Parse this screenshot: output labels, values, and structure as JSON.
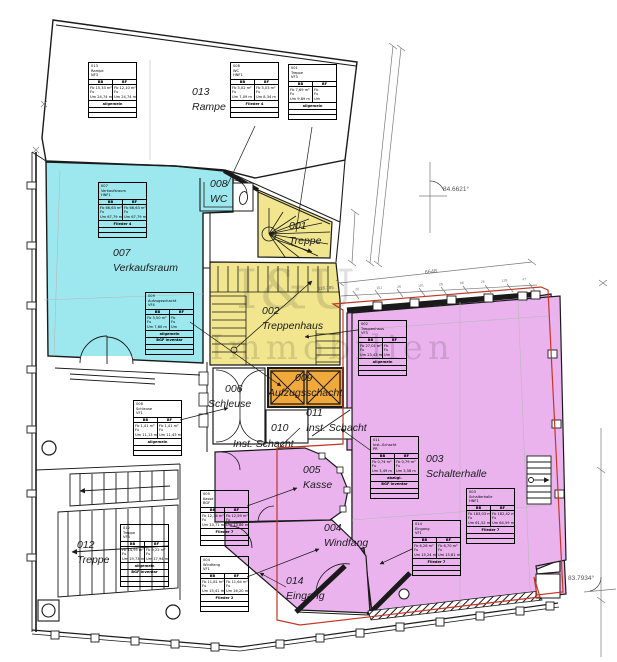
{
  "watermark": {
    "line1": "I&U",
    "line2": "Immobilien"
  },
  "rooms": {
    "rampe": {
      "number": "013",
      "name": "Rampe"
    },
    "wc": {
      "number": "008",
      "name": "WC"
    },
    "treppe1": {
      "number": "001",
      "name": "Treppe"
    },
    "verkaufsraum": {
      "number": "007",
      "name": "Verkaufsraum"
    },
    "treppenhaus": {
      "number": "002",
      "name": "Treppenhaus"
    },
    "aufzugsschacht": {
      "number": "009",
      "name": "Aufzugsschacht"
    },
    "schleuse": {
      "number": "006",
      "name": "Schleuse"
    },
    "schacht10": {
      "number": "010",
      "name": ""
    },
    "schacht11": {
      "number": "011",
      "name": "Inst. Schacht"
    },
    "schacht11b": {
      "name": "Inst. Schacht"
    },
    "kasse": {
      "number": "005",
      "name": "Kasse"
    },
    "schalterhalle": {
      "number": "003",
      "name": "Schalterhalle"
    },
    "windfang": {
      "number": "004",
      "name": "Windfang"
    },
    "eingang": {
      "number": "014",
      "name": "Eingang"
    },
    "treppe12": {
      "number": "012",
      "name": "Treppe"
    }
  },
  "dimensions": {
    "angle_top": "84.6621°",
    "angle_right": "83.7934°",
    "chain_label": "118.385",
    "span": "6648",
    "chain_ticks": [
      "20",
      "151",
      "26",
      "101",
      "26",
      "88",
      "26",
      "128",
      "47"
    ]
  },
  "stamps": [
    {
      "no": "013",
      "name": "Rampe",
      "type": "NF3",
      "c1": "BB",
      "c2": "BF",
      "l": "Fb 15,33 m²<br>Fu<br>Um 24,74 m",
      "r": "Fb 12,10 m²<br>Fu<br>Um 24,74 m",
      "footer": "allgemein",
      "footer2": ""
    },
    {
      "no": "008",
      "name": "WC",
      "type": "HNF1",
      "c1": "BB",
      "c2": "BF",
      "l": "Fb 5,02 m²<br>Fu<br>Um 7,09 m",
      "r": "Fb 5,03 m²<br>Fu<br>Um 8,34 m",
      "footer": "Flieder 4",
      "footer2": ""
    },
    {
      "no": "001",
      "name": "Treppe",
      "type": "VF3",
      "c1": "BB",
      "c2": "BF",
      "l": "Fb 7,69 m²<br>Fu<br>Um 9,89 m",
      "r": "Fb<br>Fu<br>Um",
      "footer": "allgemein",
      "footer2": ""
    },
    {
      "no": "007",
      "name": "Verkaufsraum",
      "type": "HNF1",
      "c1": "BB",
      "c2": "BF",
      "l": "Fb 66,63 m²<br>Fu<br>Um 67,79 m",
      "r": "Fb 66,63 m²<br>Fu<br>Um 67,79 m",
      "footer": "Flieder 4",
      "footer2": ""
    },
    {
      "no": "009",
      "name": "Aufzugsschacht",
      "type": "VF4",
      "c1": "BB",
      "c2": "BF",
      "l": "Fb 3,50 m²<br>Fu<br>Um 7,60 m",
      "r": "Fb<br>Fu<br>Um",
      "footer": "allgemein",
      "footer2": "BGF inventar"
    },
    {
      "no": "006",
      "name": "Schleuse",
      "type": "VF1",
      "c1": "BB",
      "c2": "BF",
      "l": "Fb 1,41 m²<br>Fu<br>Um 11,13 m",
      "r": "Fb 1,41 m²<br>Fu<br>Um 11,43 m",
      "footer": "allgemein",
      "footer2": ""
    },
    {
      "no": "002",
      "name": "Treppenhaus",
      "type": "VF3",
      "c1": "BB",
      "c2": "BF",
      "l": "Fb 27,01 m²<br>Fu<br>Um 23,43 m",
      "r": "Fb<br>Fu<br>Um",
      "footer": "allgemein",
      "footer2": ""
    },
    {
      "no": "011",
      "name": "Inst.-Schacht",
      "type": "PR",
      "c1": "BB",
      "c2": "BF",
      "l": "Fb 0,74 m²<br>Fu<br>Um 3,49 m",
      "r": "Fb 0,79 m²<br>Fu<br>Um 3,58 m",
      "footer": "abzügl.",
      "footer2": "BGF inventar"
    },
    {
      "no": "003",
      "name": "Schalterhalle",
      "type": "HNF1",
      "c1": "BB",
      "c2": "BF",
      "l": "Fb 183,03 m²<br>Fu<br>Um 61,52 m",
      "r": "Fb 182,42 m²<br>Fu<br>Um 64,59 m",
      "footer": "Flieder 7",
      "footer2": ""
    },
    {
      "no": "014",
      "name": "Eingang",
      "type": "VF1",
      "c1": "BB",
      "c2": "BF",
      "l": "Fb 6,26 m²<br>Fu<br>Um 15,24 m",
      "r": "Fb 6,70 m²<br>Fu<br>Um 15,81 m",
      "footer": "Flieder 7",
      "footer2": ""
    },
    {
      "no": "005",
      "name": "Kasse",
      "type": "BGF",
      "c1": "BB",
      "c2": "BF",
      "l": "Fb 12,34 m²<br>Fu<br>Um 13,71 m",
      "r": "Fb 12,59 m²<br>Fu<br>Um 13,86 m",
      "footer": "Flieder 7",
      "footer2": ""
    },
    {
      "no": "004",
      "name": "Windfang",
      "type": "VF1",
      "c1": "BB",
      "c2": "BF",
      "l": "Fb 11,81 m²<br>Fu<br>Um 15,41 m",
      "r": "Fb 11,64 m²<br>Fu<br>Um 16,20 m",
      "footer": "Flieder 2",
      "footer2": ""
    },
    {
      "no": "012",
      "name": "Treppe",
      "type": "VF3",
      "c1": "BB",
      "c2": "BF",
      "l": "Fb 14,95 m²<br>Fu<br>Um 19,73 m",
      "r": "Fb 9,22 m²<br>Fu<br>Um 17,94 m",
      "footer": "allgemein",
      "footer2": "BGF inventar"
    }
  ]
}
